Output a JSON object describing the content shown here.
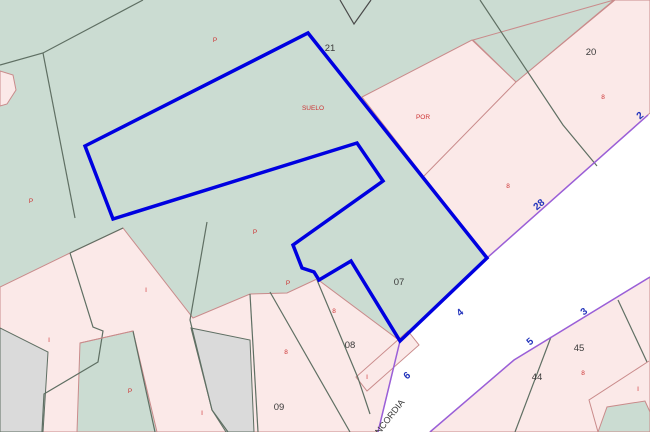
{
  "map": {
    "title": "cadastral-parcel-map",
    "colors": {
      "green": "#cbdcd2",
      "pink": "#fbe9e8",
      "pink_border": "#c98b8b",
      "gray_fill": "#dadada",
      "gray_line": "#5f6f63",
      "dark_line": "#4a4a4a",
      "selection_blue": "#0000e0",
      "road_purple": "#9a5fd8",
      "red_text": "#cc3333",
      "blue_text": "#2233bb",
      "black_text": "#3a3a3a",
      "road_white": "#ffffff"
    },
    "parcel_numbers": [
      {
        "text": "21",
        "x": 330,
        "y": 51
      },
      {
        "text": "20",
        "x": 591,
        "y": 55
      },
      {
        "text": "07",
        "x": 399,
        "y": 285
      },
      {
        "text": "08",
        "x": 350,
        "y": 348
      },
      {
        "text": "09",
        "x": 279,
        "y": 410
      },
      {
        "text": "45",
        "x": 579,
        "y": 351
      },
      {
        "text": "44",
        "x": 537,
        "y": 380
      }
    ],
    "land_use_labels": [
      {
        "text": "SUELO",
        "x": 313,
        "y": 110
      },
      {
        "text": "POR",
        "x": 423,
        "y": 119
      },
      {
        "text": "P",
        "x": 215,
        "y": 42
      },
      {
        "text": "P",
        "x": 31,
        "y": 203
      },
      {
        "text": "P",
        "x": 255,
        "y": 234
      },
      {
        "text": "P",
        "x": 288,
        "y": 285
      },
      {
        "text": "P",
        "x": 130,
        "y": 393
      },
      {
        "text": "8",
        "x": 603,
        "y": 99
      },
      {
        "text": "8",
        "x": 508,
        "y": 188
      },
      {
        "text": "8",
        "x": 334,
        "y": 313
      },
      {
        "text": "8",
        "x": 286,
        "y": 354
      },
      {
        "text": "8",
        "x": 583,
        "y": 375
      },
      {
        "text": "I",
        "x": 146,
        "y": 292
      },
      {
        "text": "I",
        "x": 49,
        "y": 342
      },
      {
        "text": "I",
        "x": 367,
        "y": 379
      },
      {
        "text": "I",
        "x": 638,
        "y": 391
      },
      {
        "text": "I",
        "x": 202,
        "y": 415
      }
    ],
    "street_numbers": [
      {
        "text": "2",
        "x": 642,
        "y": 118,
        "rot": -40
      },
      {
        "text": "28",
        "x": 541,
        "y": 207,
        "rot": -40
      },
      {
        "text": "4",
        "x": 462,
        "y": 315,
        "rot": -40
      },
      {
        "text": "6",
        "x": 409,
        "y": 378,
        "rot": -40
      },
      {
        "text": "3",
        "x": 586,
        "y": 314,
        "rot": -40
      },
      {
        "text": "5",
        "x": 532,
        "y": 344,
        "rot": -40
      }
    ],
    "street_name": {
      "text": "CONCORDIA",
      "x": 388,
      "y": 424,
      "rot": -52
    }
  }
}
